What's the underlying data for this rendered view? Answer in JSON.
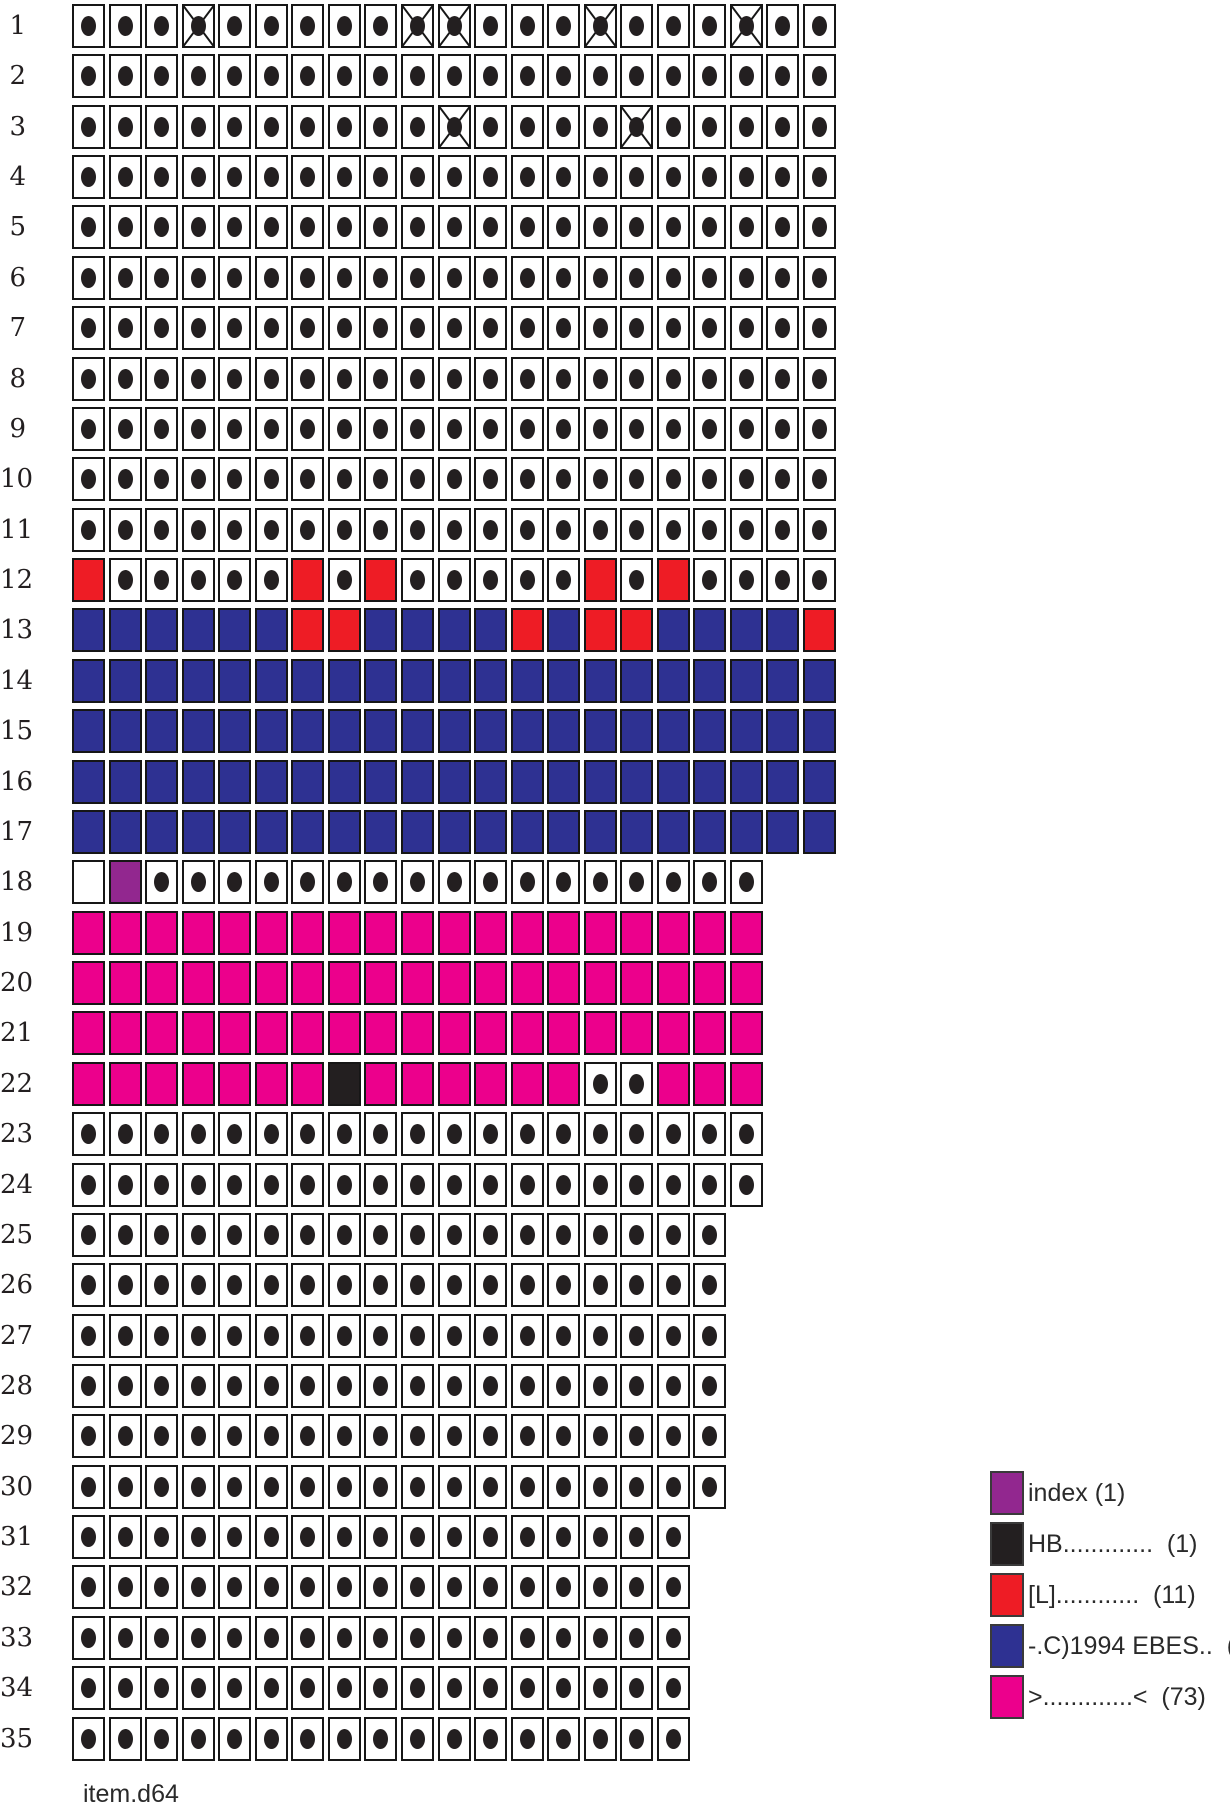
{
  "filename": "item.d64",
  "colors": {
    "background": "#ffffff",
    "cell_border": "#161616",
    "dot": "#231F20",
    "free": "#ffffff",
    "empty": "#ffffff",
    "index": "#92278F",
    "hb": "#231F20",
    "l_file": "#EE1C25",
    "ebes_file": "#2E3192",
    "angle_file": "#EC008C"
  },
  "legend": {
    "items": [
      {
        "key": "index",
        "color": "#92278F",
        "label": "index (1)"
      },
      {
        "key": "hb",
        "color": "#231F20",
        "label": "HB.............  (1)"
      },
      {
        "key": "l_file",
        "color": "#EE1C25",
        "label": "[L]............  (11)"
      },
      {
        "key": "ebes_file",
        "color": "#2E3192",
        "label": "-.C)1994 EBES..  (99)"
      },
      {
        "key": "angle_file",
        "color": "#EC008C",
        "label": ">.............<  (73)"
      }
    ]
  },
  "chart_data": {
    "type": "heatmap",
    "title": "",
    "xlabel": "",
    "ylabel": "",
    "legend_position": "bottom-right",
    "row_labels": [
      "1",
      "2",
      "3",
      "4",
      "5",
      "6",
      "7",
      "8",
      "9",
      "10",
      "11",
      "12",
      "13",
      "14",
      "15",
      "16",
      "17",
      "18",
      "19",
      "20",
      "21",
      "22",
      "23",
      "24",
      "25",
      "26",
      "27",
      "28",
      "29",
      "30",
      "31",
      "32",
      "33",
      "34",
      "35"
    ],
    "sectors_per_track": [
      21,
      21,
      21,
      21,
      21,
      21,
      21,
      21,
      21,
      21,
      21,
      21,
      21,
      21,
      21,
      21,
      21,
      19,
      19,
      19,
      19,
      19,
      19,
      19,
      18,
      18,
      18,
      18,
      18,
      18,
      17,
      17,
      17,
      17,
      17
    ],
    "cell_codes": {
      "d": "free block (dot)",
      "x": "free block with X mark",
      "e": "empty white block",
      "P": "index (1)",
      "K": "HB............. (1)",
      "R": "[L]............ (11)",
      "B": "-.C)1994 EBES.. (99)",
      "M": ">.............< (73)"
    },
    "rows": [
      "dddxdddddxxdddxdddxdd",
      "ddddddddddddddddddddd",
      "ddddddddddxddddxddddd",
      "ddddddddddddddddddddd",
      "ddddddddddddddddddddd",
      "ddddddddddddddddddddd",
      "ddddddddddddddddddddd",
      "ddddddddddddddddddddd",
      "ddddddddddddddddddddd",
      "ddddddddddddddddddddd",
      "ddddddddddddddddddddd",
      "RdddddRdRdddddRdRdddd",
      "BBBBBBRRBBBBRBRRBBBBR",
      "BBBBBBBBBBBBBBBBBBBBB",
      "BBBBBBBBBBBBBBBBBBBBB",
      "BBBBBBBBBBBBBBBBBBBBB",
      "BBBBBBBBBBBBBBBBBBBBB",
      "ePddddddddddddddddd",
      "MMMMMMMMMMMMMMMMMMM",
      "MMMMMMMMMMMMMMMMMMM",
      "MMMMMMMMMMMMMMMMMMM",
      "MMMMMMMKMMMMMMddMMM",
      "ddddddddddddddddddd",
      "ddddddddddddddddddd",
      "dddddddddddddddddd",
      "dddddddddddddddddd",
      "dddddddddddddddddd",
      "dddddddddddddddddd",
      "dddddddddddddddddd",
      "dddddddddddddddddd",
      "ddddddddddddddddd",
      "ddddddddddddddddd",
      "ddddddddddddddddd",
      "ddddddddddddddddd",
      "ddddddddddddddddd"
    ],
    "block_counts": {
      "index": 1,
      "hb": 1,
      "l_file": 11,
      "ebes_file": 99,
      "angle_file": 73
    }
  }
}
